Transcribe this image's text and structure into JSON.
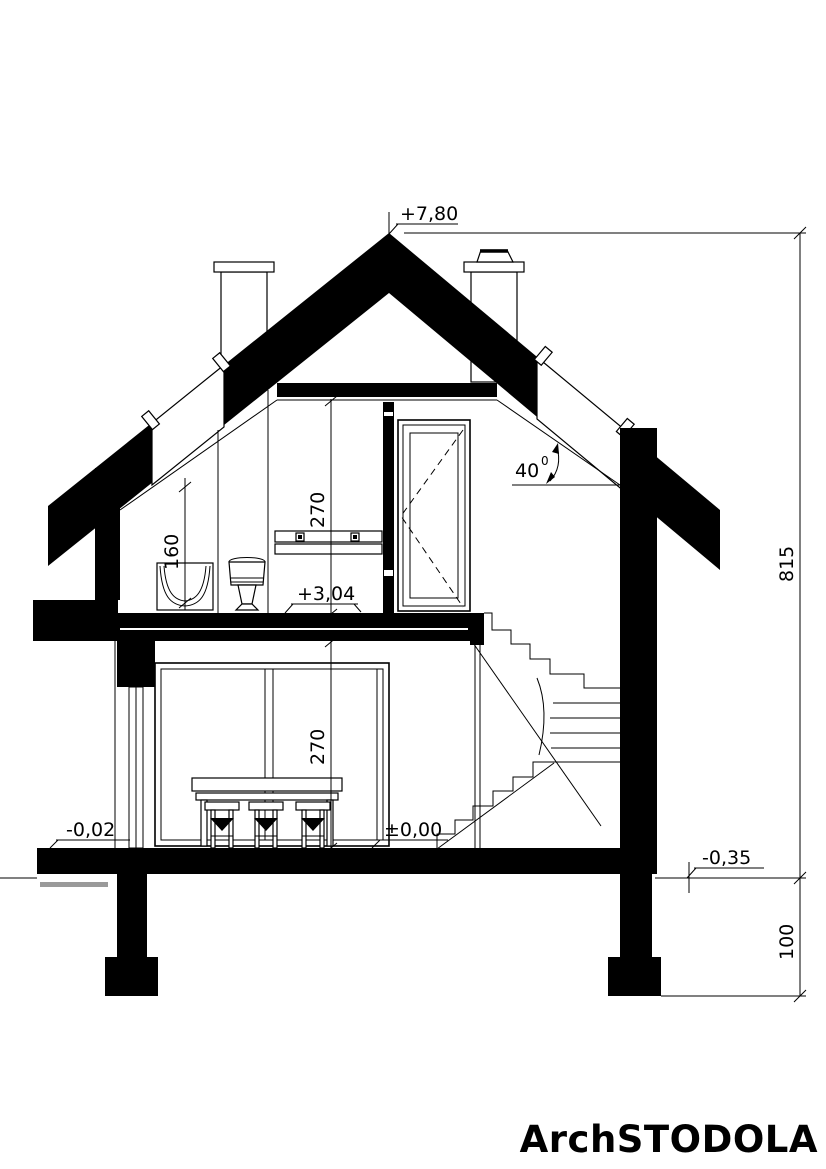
{
  "drawing": {
    "title": "house-cross-section",
    "logo": "ArchSTODOLA",
    "annotations": {
      "peak_level": "+7,80",
      "attic_floor_level": "+3,04",
      "ground_floor_level": "±0,00",
      "entry_level": "-0,02",
      "terrain_level": "-0,35",
      "total_height": "815",
      "foundation_depth": "100",
      "attic_room_height": "270",
      "ground_room_height": "270",
      "knee_height": "160",
      "roof_pitch": "40",
      "roof_pitch_sup": "0"
    },
    "colors": {
      "ink": "#000000",
      "paper": "#ffffff"
    }
  }
}
